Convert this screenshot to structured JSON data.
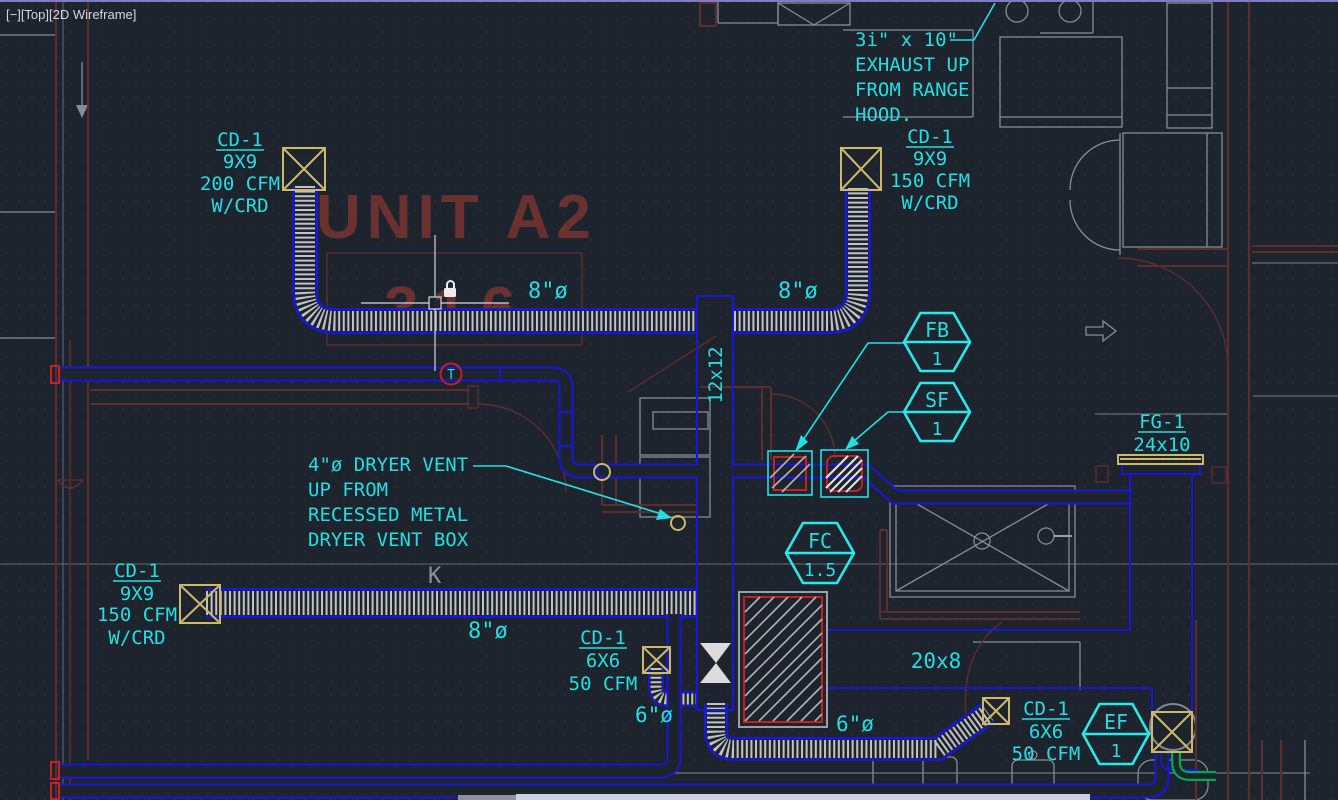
{
  "viewport": {
    "controls": "[−][Top][2D Wireframe]"
  },
  "room": {
    "name": "UNIT A2",
    "number": "316"
  },
  "notes": {
    "exhaust": [
      "3i\" x 10\"",
      "EXHAUST UP",
      "FROM RANGE",
      "HOOD."
    ],
    "dryer": [
      "4\"ø DRYER VENT",
      "UP FROM",
      "RECESSED METAL",
      "DRYER VENT BOX"
    ]
  },
  "diffusers": [
    {
      "tag": "CD-1",
      "size": "9X9",
      "flow": "200 CFM",
      "extra": "W/CRD"
    },
    {
      "tag": "CD-1",
      "size": "9X9",
      "flow": "150 CFM",
      "extra": "W/CRD"
    },
    {
      "tag": "CD-1",
      "size": "9X9",
      "flow": "150 CFM",
      "extra": "W/CRD"
    },
    {
      "tag": "CD-1",
      "size": "6X6",
      "flow": "50 CFM"
    },
    {
      "tag": "CD-1",
      "size": "6X6",
      "flow": "50 CFM"
    }
  ],
  "grille": {
    "tag": "FG-1",
    "size": "24x10"
  },
  "tags": {
    "fb": {
      "label": "FB",
      "number": "1"
    },
    "sf": {
      "label": "SF",
      "number": "1"
    },
    "fc": {
      "label": "FC",
      "number": "1.5"
    },
    "ef": {
      "label": "EF",
      "number": "1"
    }
  },
  "ducts": {
    "d8a": "8\"ø",
    "d8b": "8\"ø",
    "d8c": "8\"ø",
    "d12": "12x12",
    "d20x8": "20x8",
    "d6a": "6\"ø",
    "d6b": "6\"ø"
  },
  "symbols": {
    "thermostat": "T",
    "kitchen": "K"
  },
  "colors": {
    "background": "#1e242e",
    "annotation_cyan": "#24dfe2",
    "duct_blue": "#1717d9",
    "diffuser_yellow": "#ccb96b",
    "wall_dark_red": "#5c2d2b",
    "accent_red": "#c42121",
    "room_text_red": "#6a3130",
    "architecture_gray": "#868d96",
    "exhaust_green": "#00a84f",
    "viewport_border": "#7d7dc0"
  }
}
